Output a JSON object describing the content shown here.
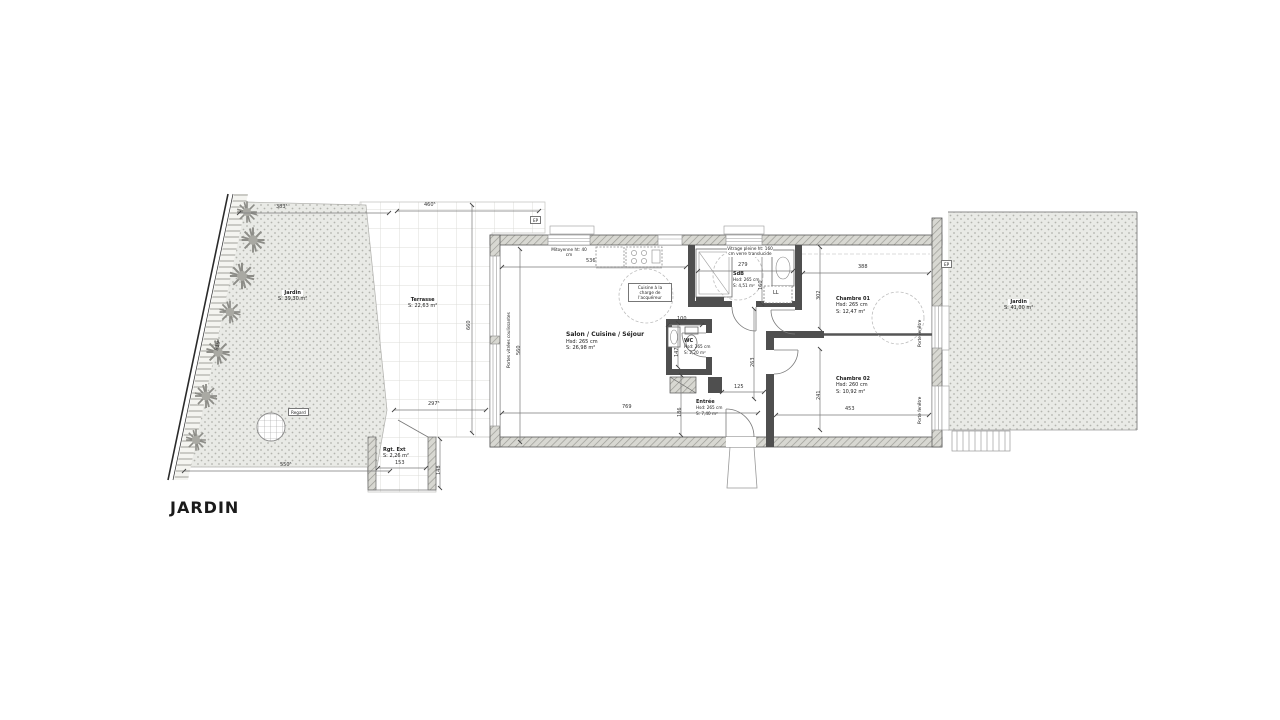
{
  "plan": {
    "title": "JARDIN",
    "rooms": {
      "salon": {
        "name": "Salon / Cuisine / Séjour",
        "height": "Hsd: 265 cm",
        "area": "S: 26,98 m²"
      },
      "wc": {
        "name": "WC",
        "height": "Hsd: 265 cm",
        "area": "S: 2,20 m²"
      },
      "sdb": {
        "name": "SdB",
        "height": "Hsd: 265 cm",
        "area": "S: 4,51 m²"
      },
      "entree": {
        "name": "Entrée",
        "height": "Hsd: 265 cm",
        "area": "S: 7,40 m²"
      },
      "chambre1": {
        "name": "Chambre 01",
        "height": "Hsd: 265 cm",
        "area": "S: 12,47 m²"
      },
      "chambre2": {
        "name": "Chambre 02",
        "height": "Hsd: 260 cm",
        "area": "S: 10,92 m²"
      }
    },
    "exterior": {
      "jardin_left": {
        "name": "Jardin",
        "area": "S: 39,30 m²"
      },
      "terrasse": {
        "name": "Terrasse",
        "area": "S: 22,63 m²"
      },
      "jardin_right": {
        "name": "Jardin",
        "area": "S: 41,00 m²"
      },
      "rgt_ext": {
        "name": "Rgt. Ext",
        "area": "S: 2,26 m²"
      }
    },
    "notes": {
      "cuisine": "Cuisine à la charge de l'acquéreur",
      "mitoyenne": "Mitoyenne ht: 40 cm",
      "vitrage": "Vitrage pleine ht: 160 cm verre translucide",
      "portes_vitrees": "Portes vitrées coulissantes",
      "porte_fenetre": "Porte fenêtre",
      "regard": "Regard",
      "ep": "EP",
      "ll": "LL"
    },
    "dims": {
      "d383": "383⁵",
      "d460": "460⁵",
      "d550": "550⁵",
      "d297": "297⁵",
      "d819": "819",
      "d660": "660",
      "d560": "560",
      "d536": "536",
      "d279": "279",
      "d160": "160",
      "d100": "100",
      "d147": "147",
      "d769": "769",
      "d186": "186",
      "d125": "125",
      "d263": "263",
      "d388": "388",
      "d302": "302",
      "d241": "241",
      "d453": "453",
      "d153": "153",
      "d148": "148"
    }
  },
  "colors": {
    "wall_hatch": "#d8d8d2",
    "wall_dark": "#4f4f4f",
    "garden_fill": "#e9eae6",
    "grid_line": "#dcdcd8",
    "line": "#555555",
    "text": "#222222"
  }
}
